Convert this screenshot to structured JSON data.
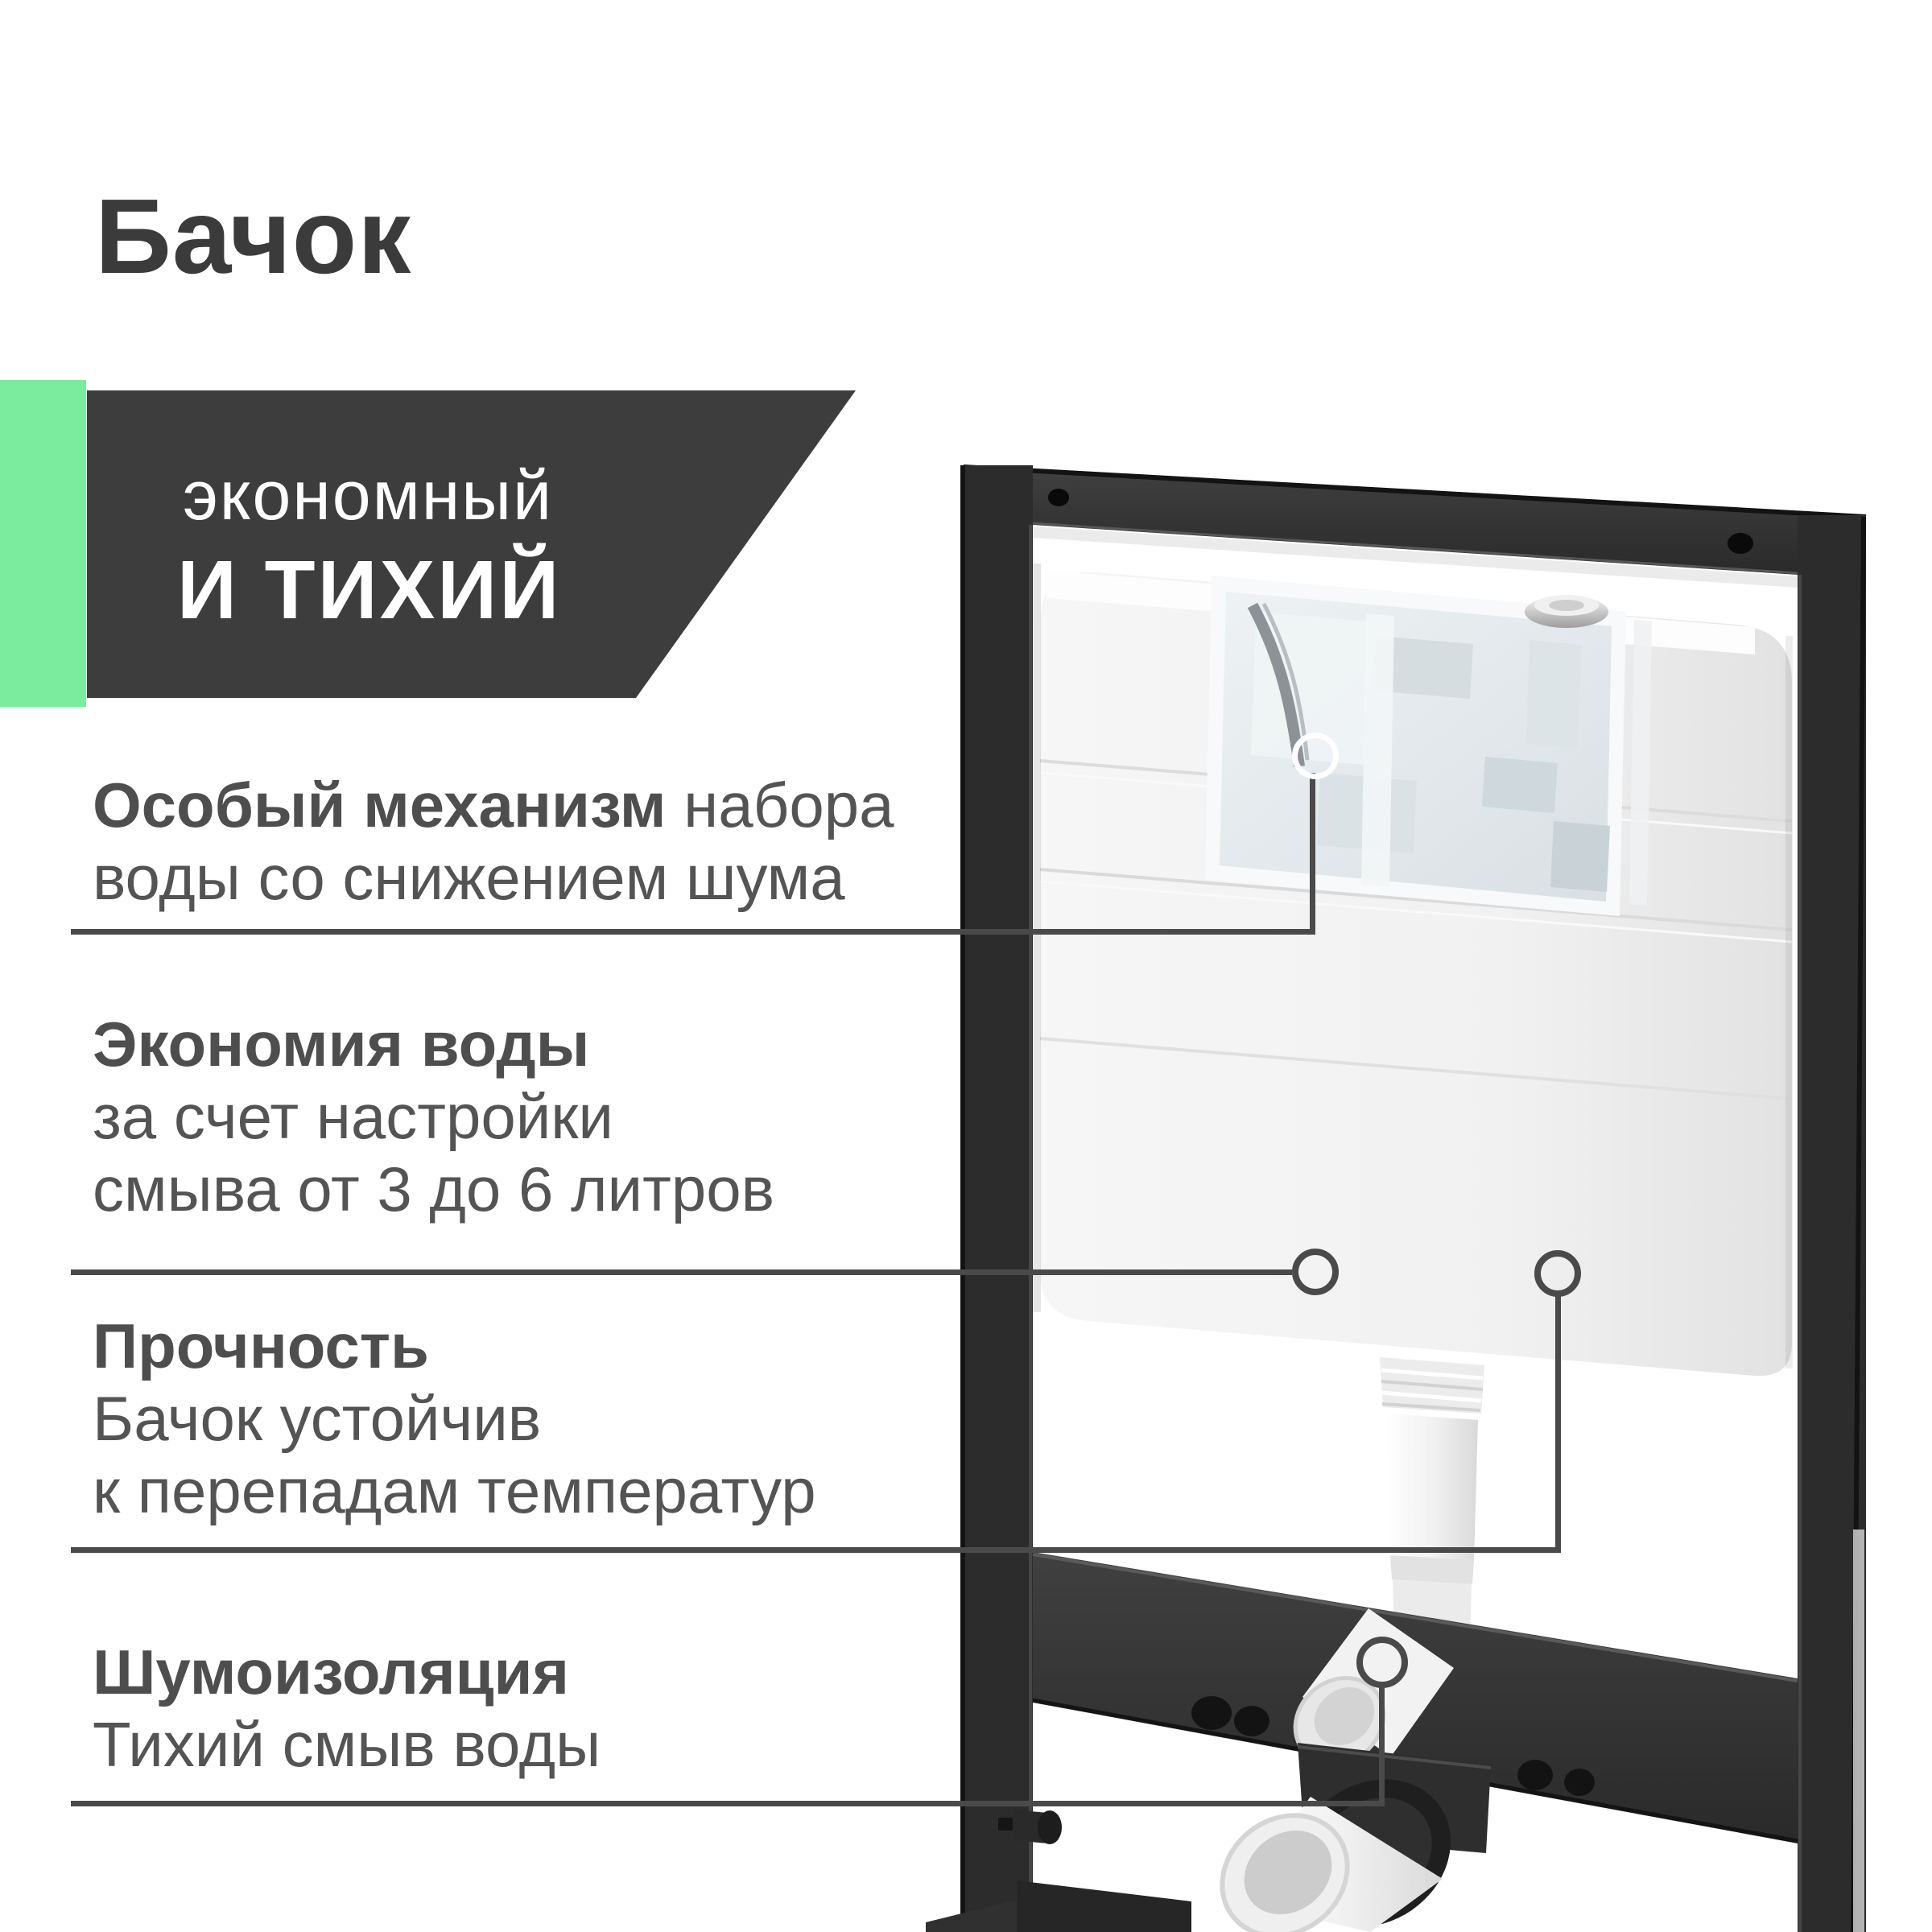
{
  "page": {
    "title": "Бачок"
  },
  "badge": {
    "line1": "экономный",
    "line2": "и тихий",
    "bg": "#3d3d3d",
    "accent_green": "#7bec9d",
    "text_color": "#ffffff"
  },
  "features": [
    {
      "head": "Особый механизм",
      "head_suffix": " набора",
      "lines": [
        "воды со снижением шума"
      ]
    },
    {
      "head": "Экономия воды",
      "head_suffix": "",
      "lines": [
        "за счет настройки",
        "смыва от 3 до 6 литров"
      ]
    },
    {
      "head": "Прочность",
      "head_suffix": "",
      "lines": [
        "Бачок устойчив",
        "к перепадам температур"
      ]
    },
    {
      "head": "Шумоизоляция",
      "head_suffix": "",
      "lines": [
        "Тихий смыв воды"
      ]
    }
  ],
  "colors": {
    "title_color": "#3b3b3b",
    "body_text": "#545454",
    "callout_line": "#4a4a4a",
    "frame": "#2c2c2c",
    "tank": "#f4f4f4",
    "window": "#e8edf0"
  },
  "callouts": [
    {
      "target": "fill-mechanism-window"
    },
    {
      "target": "tank-front-left"
    },
    {
      "target": "tank-front-right"
    },
    {
      "target": "flush-elbow"
    }
  ]
}
